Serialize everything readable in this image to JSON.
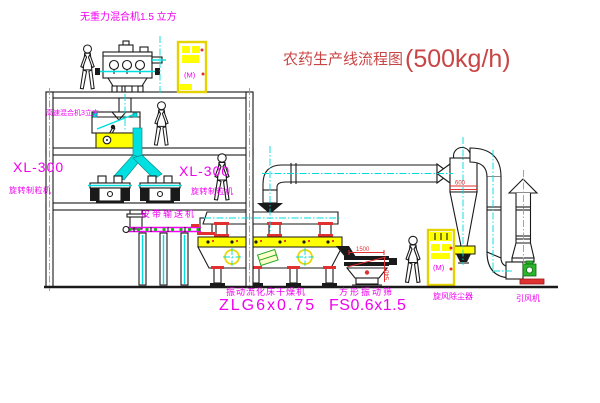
{
  "title": {
    "text": "农药生产线流程图",
    "capacity": "(500kg/h)"
  },
  "labels": {
    "top_mixer": "无重力混合机1.5 立方",
    "hs_mixer": "高速混合机3立方",
    "granulator_left_model": "XL-300",
    "granulator_left_name": "旋转制粒机",
    "granulator_right_model": "XL-300",
    "granulator_right_name": "旋转制粒机",
    "belt_conveyor": "皮带输送机",
    "dryer_name": "振动流化床干燥机",
    "dryer_model": "ZLG6x0.75",
    "sieve_name": "方形振动筛",
    "sieve_model": "FS0.6x1.5",
    "cyclone": "旋风除尘器",
    "fan": "引风机",
    "motor_mark": "(M)"
  },
  "dimensions": {
    "sieve_width": "1500",
    "sieve_height": "540",
    "cyclone_band": "600"
  },
  "colors": {
    "label_magenta": "#f000f0",
    "title_red": "#c94545",
    "cad_yellow": "#ffff00",
    "cad_cyan": "#00e0e0",
    "line_black": "#1a1a1a",
    "accent_red": "#e03030",
    "motor_green": "#2ab52a"
  }
}
